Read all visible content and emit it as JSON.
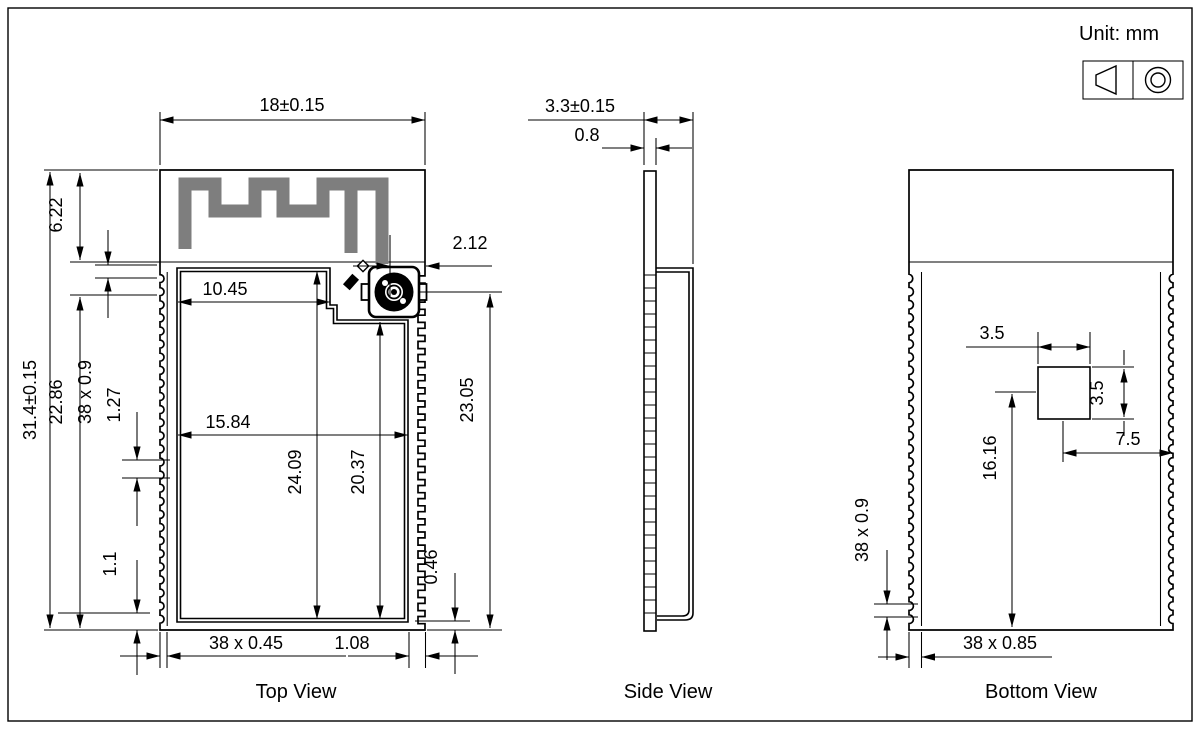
{
  "unit_note": "Unit: mm",
  "projection_symbol": {
    "left_icon": "truncated-cone-icon",
    "right_icon": "concentric-circles-icon"
  },
  "top_view": {
    "label": "Top View",
    "width": "18±0.15",
    "overall_height": "31.4±0.15",
    "antenna_height": "6.22",
    "pin_row_height": "22.86",
    "pin_pitch": "38 x 0.9",
    "pitch": "1.27",
    "bottom_margin": "1.1",
    "shield_upper_width": "10.45",
    "shield_width": "15.84",
    "shield_height": "24.09",
    "shield_lower_height": "20.37",
    "connector_offset": "2.12",
    "connector_to_bottom": "23.05",
    "pad_size": "38 x 0.45",
    "corner_gap": "1.08",
    "pad_inset": "0.46"
  },
  "side_view": {
    "label": "Side View",
    "thickness": "3.3±0.15",
    "pcb_thickness": "0.8"
  },
  "bottom_view": {
    "label": "Bottom View",
    "pad_width": "3.5",
    "pad_height": "3.5",
    "pad_center_to_right": "7.5",
    "pad_center_to_bottom": "16.16",
    "pin_pitch": "38 x 0.9",
    "pad_size": "38 x 0.85"
  }
}
